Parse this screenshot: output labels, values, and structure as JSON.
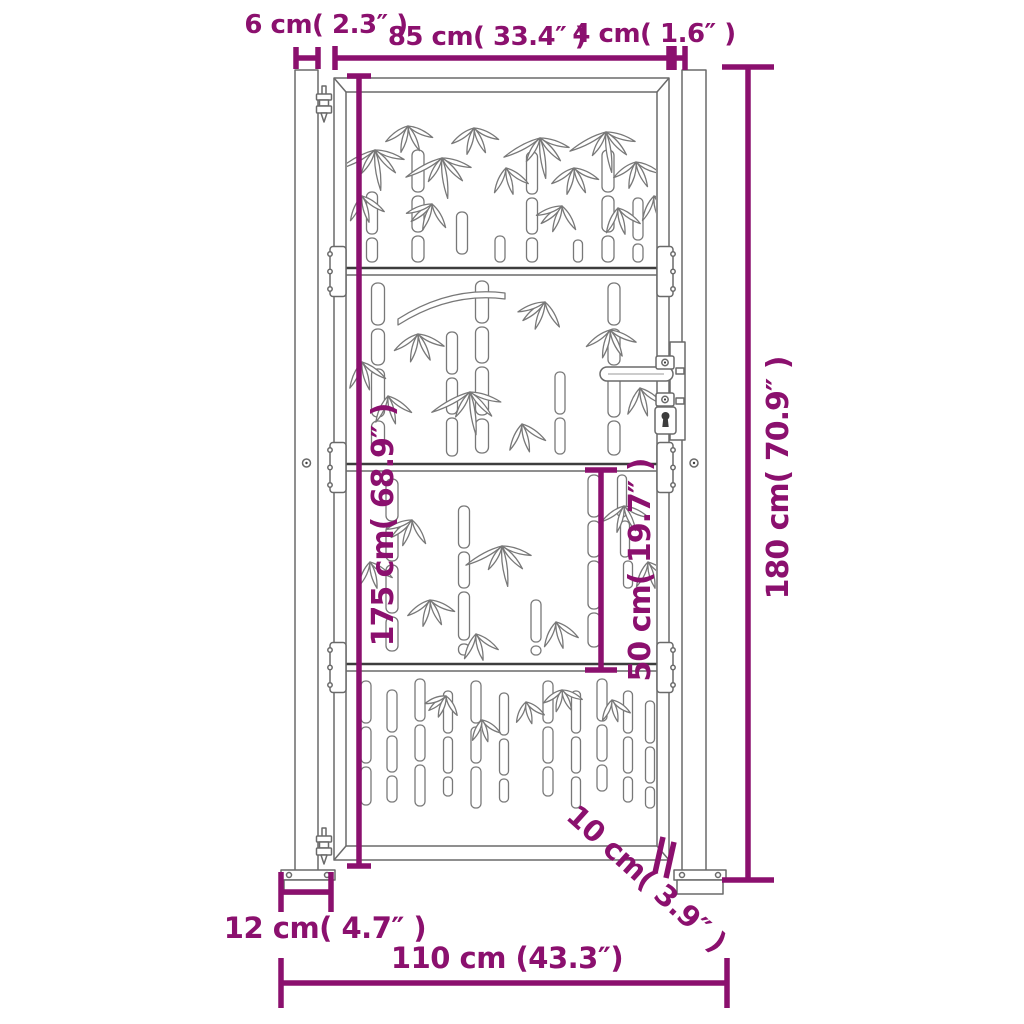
{
  "figure": {
    "type": "product dimension diagram",
    "description": "Front-view line drawing of a garden gate with bamboo laser-cut panels mounted between two square posts, annotated with purple dimension lines"
  },
  "colors": {
    "accent": "#8B106E",
    "line": "#6a6a6a"
  },
  "dimensions": {
    "post_width": {
      "label": "6 cm( 2.3″ )",
      "cm": 6,
      "inch": 2.3
    },
    "gate_width": {
      "label": "85 cm( 33.4″ )",
      "cm": 85,
      "inch": 33.4
    },
    "hinge_gap": {
      "label": "4 cm( 1.6″ )",
      "cm": 4,
      "inch": 1.6
    },
    "gate_height": {
      "label": "175 cm( 68.9″ )",
      "cm": 175,
      "inch": 68.9
    },
    "post_height": {
      "label": "180 cm( 70.9″ )",
      "cm": 180,
      "inch": 70.9
    },
    "panel_height": {
      "label": "50 cm( 19.7″ )",
      "cm": 50,
      "inch": 19.7
    },
    "foot_width": {
      "label": "12 cm( 4.7″ )",
      "cm": 12,
      "inch": 4.7
    },
    "ground_clearance": {
      "label": "10 cm( 3.9″ )",
      "cm": 10,
      "inch": 3.9
    },
    "total_width": {
      "label": "110 cm (43.3″)",
      "cm": 110,
      "inch": 43.3
    }
  }
}
